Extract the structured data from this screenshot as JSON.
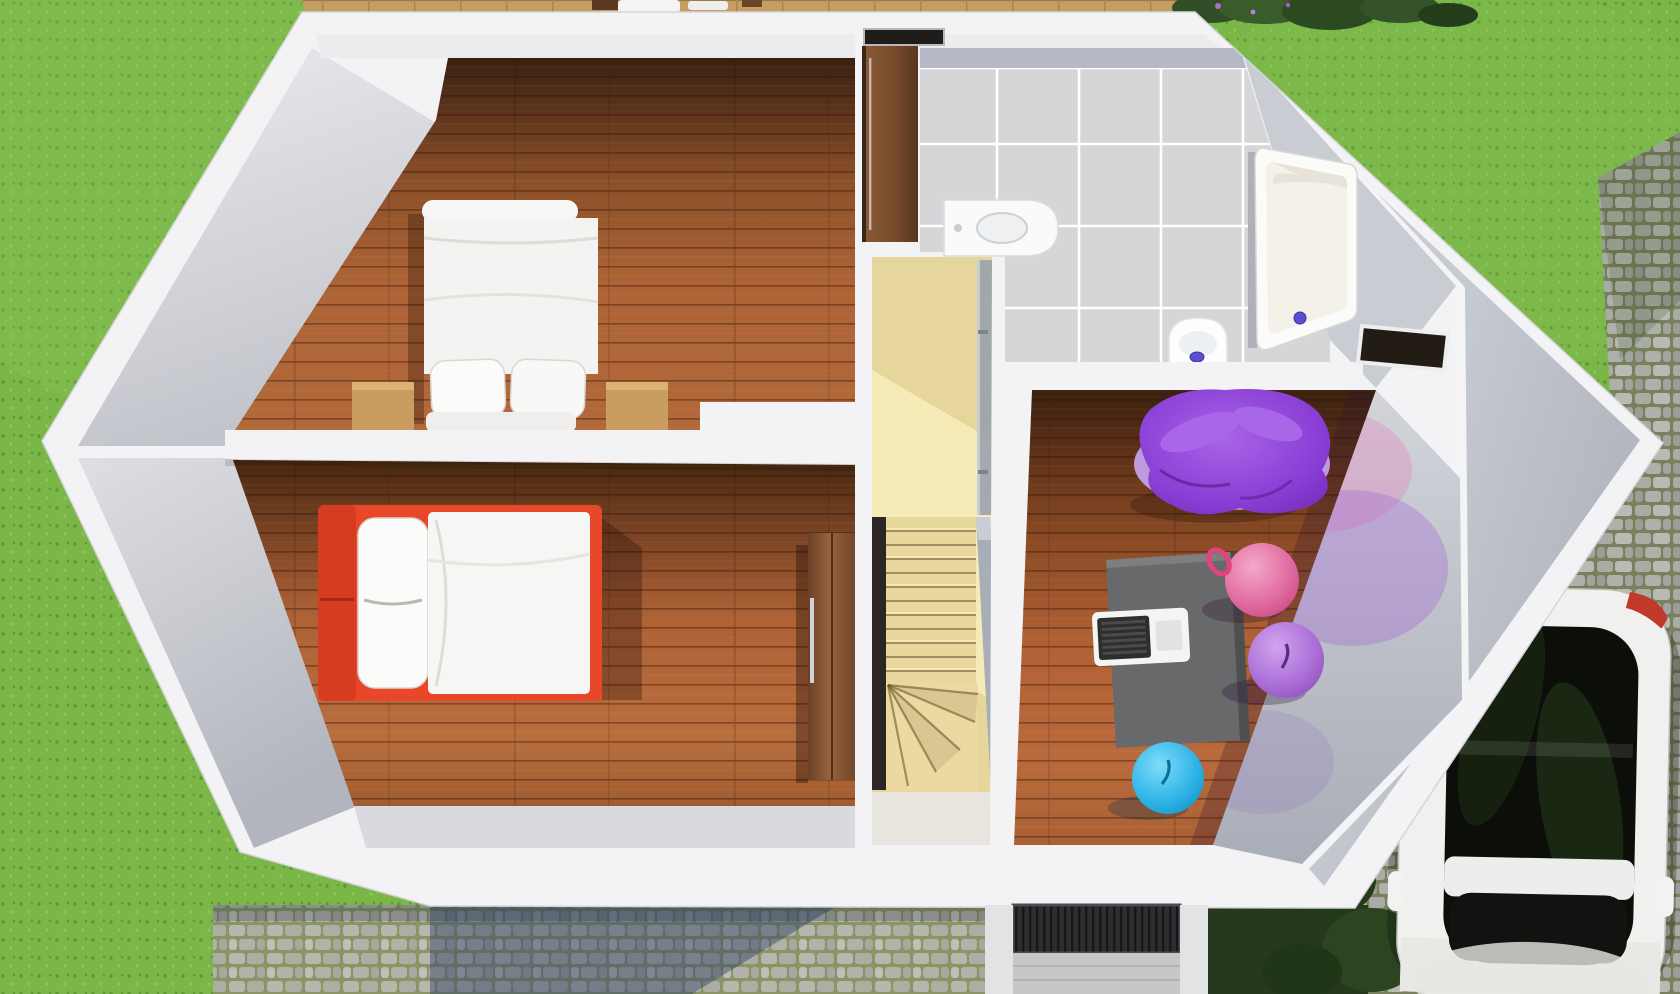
{
  "view": {
    "type": "3D floor plan render",
    "angle": "top-down cutaway",
    "level": "upper floor of a house"
  },
  "colors": {
    "grass": "#7ab648",
    "deck_wood": "#c49e63",
    "wall_white": "#f3f3f5",
    "wall_face": "#c3c6cc",
    "tile_floor": "#d6d6d8",
    "tile_band": "#b4b9c5",
    "grout_white": "#ffffff",
    "stairs_beige": "#e6d69b",
    "stairs_sunlit": "#f8eebc",
    "stairs_void": "#2c2724",
    "railing_gray": "#a7aeb8",
    "landing_gray": "#e8e5df",
    "bed_white": "#f7f7f5",
    "bed_red": "#e8472a",
    "nightstand_wood": "#c99c5f",
    "desk_gray": "#68696b",
    "laptop_white": "#f4f4f2",
    "laptop_keys": "#2e2e2c",
    "beanbag_purple": "#8a3fd6",
    "beanbag_base": "#bb9bdc",
    "ball_pink": "#e06ba0",
    "ball_purple": "#ab6fd6",
    "ball_blue": "#2fb4e8",
    "drain_blue": "#5a4fd0",
    "tub_white": "#fbfbf9",
    "tub_inner": "#f4f1e8",
    "toilet_white": "#fdfdfd",
    "sink_white": "#fafafa",
    "car_white": "#f0f0ee",
    "car_glass": "#0c0e0a",
    "car_taillight": "#c0392b",
    "grate_dark": "#2e2e30",
    "ramp_gray": "#c7c7c5",
    "niche_dark": "#221c15",
    "window_slit": "#1f1d1a",
    "porch_wall": "#e3e3e6",
    "bush_green": "#314e26"
  },
  "rooms": [
    {
      "id": "bedroom-main",
      "name": "bedroom with double bed",
      "floor": "hardwood planks"
    },
    {
      "id": "bedroom-second",
      "name": "bedroom with single red bed",
      "floor": "hardwood planks"
    },
    {
      "id": "bathroom",
      "name": "bathroom",
      "floor": "gray tiles with white grout"
    },
    {
      "id": "playroom",
      "name": "play room / study",
      "floor": "hardwood planks"
    },
    {
      "id": "stairwell",
      "name": "staircase hall",
      "floor": "light wood"
    }
  ],
  "furniture": [
    {
      "id": "double-bed",
      "room": "bedroom-main",
      "desc": "white double bed, two pillows, two wooden nightstands"
    },
    {
      "id": "single-bed",
      "room": "bedroom-second",
      "desc": "single bed with red frame, white pillow and duvet"
    },
    {
      "id": "wardrobe",
      "room": "bedroom-second",
      "desc": "tall brown wardrobe beside stairwell"
    },
    {
      "id": "tall-cabinet",
      "room": "bathroom",
      "desc": "brown cabinet against top wall"
    },
    {
      "id": "bathtub",
      "room": "bathroom",
      "desc": "white bathtub with blue drain"
    },
    {
      "id": "toilet",
      "room": "bathroom",
      "desc": "white toilet with blue flush"
    },
    {
      "id": "washbasin",
      "room": "bathroom",
      "desc": "white rounded basin"
    },
    {
      "id": "staircase",
      "room": "stairwell",
      "desc": "straight flight with winder steps at bottom"
    },
    {
      "id": "desk",
      "room": "playroom",
      "desc": "gray desk with white laptop"
    },
    {
      "id": "bean-bag",
      "room": "playroom",
      "desc": "purple crumpled bean-bag chair on lavender base"
    },
    {
      "id": "gym-balls",
      "room": "playroom",
      "desc": "pink, purple and blue exercise balls"
    }
  ],
  "exterior": [
    {
      "id": "lawn",
      "desc": "green grass surrounding house"
    },
    {
      "id": "wooden-deck",
      "desc": "deck with white chairs along top edge"
    },
    {
      "id": "shrubs",
      "desc": "dark green shrubs at top right corner"
    },
    {
      "id": "cobblestone-path",
      "desc": "cobbled path below house, partly in blue shadow"
    },
    {
      "id": "entrance",
      "desc": "door grate and gray ramp at bottom"
    },
    {
      "id": "driveway",
      "desc": "cobbled driveway on the right"
    },
    {
      "id": "car",
      "desc": "white car with dark glass roof, red taillight"
    }
  ]
}
